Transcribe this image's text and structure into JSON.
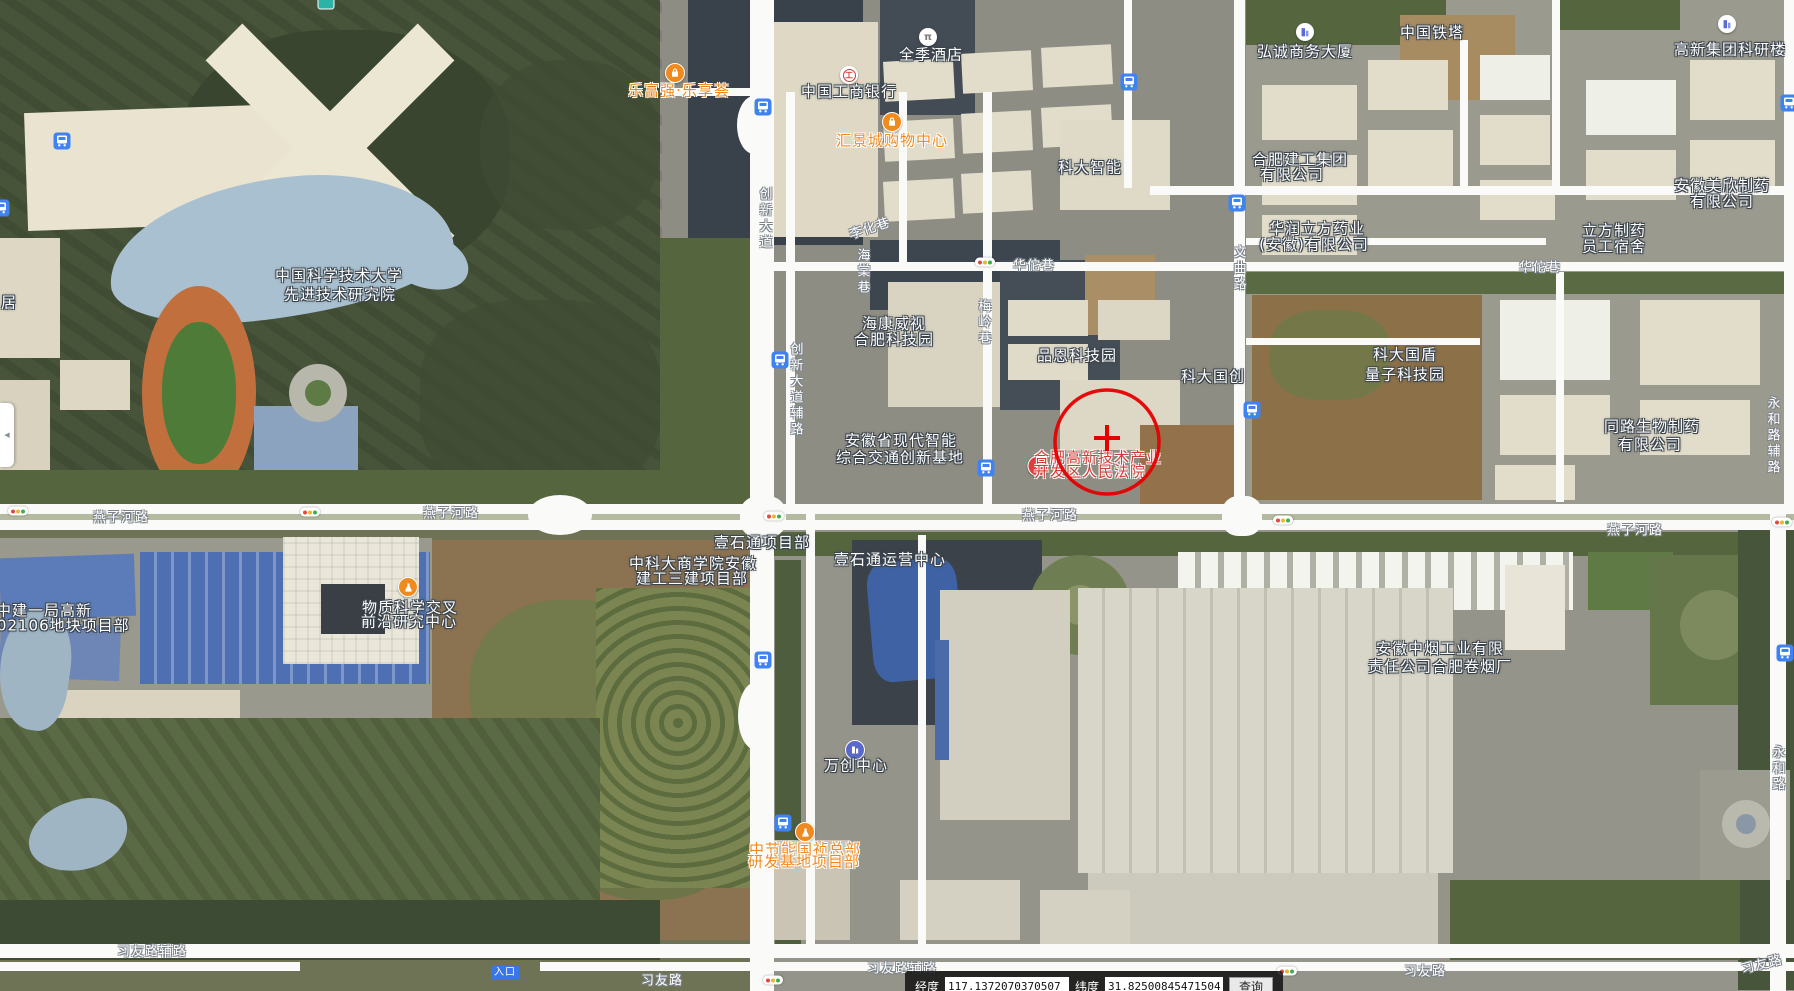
{
  "coord_bar": {
    "lng_label": "经度",
    "lng_value": "117.1372070370507",
    "lat_label": "纬度",
    "lat_value": "31.82500845471504",
    "search_label": "查询"
  },
  "entrance_tag": {
    "text": "入口",
    "x": 505,
    "y": 973
  },
  "side_panel": {
    "arrow": "◀"
  },
  "marker": {
    "circle": {
      "cx": 1107,
      "cy": 442,
      "r": 52,
      "color": "#e50000"
    },
    "cross": {
      "x": 1107,
      "y": 438,
      "arm": 13
    }
  },
  "labels": {
    "places": [
      {
        "t": "中国科学技术大学",
        "x": 339,
        "y": 276
      },
      {
        "t": "先进技术研究院",
        "x": 340,
        "y": 295
      },
      {
        "t": "中国工商银行",
        "x": 849,
        "y": 92
      },
      {
        "t": "全季酒店",
        "x": 931,
        "y": 55
      },
      {
        "t": "科大智能",
        "x": 1090,
        "y": 168
      },
      {
        "t": "弘诚商务大厦",
        "x": 1305,
        "y": 52
      },
      {
        "t": "中国铁塔",
        "x": 1432,
        "y": 33
      },
      {
        "t": "高新集团科研楼",
        "x": 1730,
        "y": 50
      },
      {
        "t": "合肥建工集团",
        "x": 1300,
        "y": 160
      },
      {
        "t": "有限公司",
        "x": 1292,
        "y": 175
      },
      {
        "t": "华润立方药业",
        "x": 1317,
        "y": 229
      },
      {
        "t": "(安徽)有限公司",
        "x": 1314,
        "y": 245
      },
      {
        "t": "立方制药",
        "x": 1614,
        "y": 231
      },
      {
        "t": "员工宿舍",
        "x": 1614,
        "y": 247
      },
      {
        "t": "安徽美欣制药",
        "x": 1722,
        "y": 186
      },
      {
        "t": "有限公司",
        "x": 1722,
        "y": 202
      },
      {
        "t": "海康威视",
        "x": 894,
        "y": 324
      },
      {
        "t": "合肥科技园",
        "x": 894,
        "y": 340
      },
      {
        "t": "品恩科技园",
        "x": 1077,
        "y": 356
      },
      {
        "t": "科大国创",
        "x": 1213,
        "y": 377
      },
      {
        "t": "科大国盾",
        "x": 1405,
        "y": 355
      },
      {
        "t": "量子科技园",
        "x": 1405,
        "y": 375
      },
      {
        "t": "同路生物制药",
        "x": 1652,
        "y": 427
      },
      {
        "t": "有限公司",
        "x": 1650,
        "y": 445
      },
      {
        "t": "安徽省现代智能",
        "x": 901,
        "y": 441
      },
      {
        "t": "综合交通创新基地",
        "x": 900,
        "y": 458
      },
      {
        "t": "中建一局高新",
        "x": 44,
        "y": 611
      },
      {
        "t": "202106地块项目部",
        "x": 58,
        "y": 626
      },
      {
        "t": "物质科学交叉",
        "x": 410,
        "y": 608
      },
      {
        "t": "前沿研究中心",
        "x": 409,
        "y": 622
      },
      {
        "t": "中科大商学院安徽",
        "x": 693,
        "y": 564
      },
      {
        "t": "建工三建项目部",
        "x": 692,
        "y": 579
      },
      {
        "t": "壹石通项目部",
        "x": 762,
        "y": 543
      },
      {
        "t": "壹石通运营中心",
        "x": 890,
        "y": 560
      },
      {
        "t": "万创中心",
        "x": 856,
        "y": 766
      },
      {
        "t": "安徽中烟工业有限",
        "x": 1440,
        "y": 649
      },
      {
        "t": "责任公司合肥卷烟厂",
        "x": 1440,
        "y": 667
      },
      {
        "t": "居",
        "x": 9,
        "y": 303
      }
    ],
    "orange": [
      {
        "t": "乐富强·乐享荟",
        "x": 679,
        "y": 91
      },
      {
        "t": "汇景城购物中心",
        "x": 892,
        "y": 141
      },
      {
        "t": "中节能国祯总部",
        "x": 805,
        "y": 850
      },
      {
        "t": "研发基地项目部",
        "x": 804,
        "y": 862
      }
    ],
    "red": [
      {
        "t": "合肥高新技术产业",
        "x": 1098,
        "y": 458
      },
      {
        "t": "开发区人民法院",
        "x": 1090,
        "y": 472
      }
    ],
    "roads": [
      {
        "t": "创新大道",
        "x": 764,
        "y": 219,
        "v": 1
      },
      {
        "t": "创新大道辅路",
        "x": 795,
        "y": 390,
        "v": 1
      },
      {
        "t": "华佗巷",
        "x": 1034,
        "y": 266
      },
      {
        "t": "华佗巷",
        "x": 1540,
        "y": 268
      },
      {
        "t": "梅岭巷",
        "x": 983,
        "y": 323,
        "v": 1
      },
      {
        "t": "文曲路",
        "x": 1238,
        "y": 269,
        "v": 1
      },
      {
        "t": "海棠巷",
        "x": 862,
        "y": 272,
        "v": 1
      },
      {
        "t": "李化巷",
        "x": 870,
        "y": 229,
        "r": -18
      },
      {
        "t": "永和路辅路",
        "x": 1772,
        "y": 436,
        "v": 1
      },
      {
        "t": "永和路",
        "x": 1777,
        "y": 769,
        "v": 1
      },
      {
        "t": "燕子河路",
        "x": 121,
        "y": 518
      },
      {
        "t": "燕子河路",
        "x": 451,
        "y": 514
      },
      {
        "t": "燕子河路",
        "x": 1050,
        "y": 516
      },
      {
        "t": "燕子河路",
        "x": 1635,
        "y": 531
      },
      {
        "t": "习友路辅路",
        "x": 152,
        "y": 952
      },
      {
        "t": "习友路",
        "x": 662,
        "y": 981
      },
      {
        "t": "习友路辅路",
        "x": 902,
        "y": 969
      },
      {
        "t": "习友路",
        "x": 1425,
        "y": 972
      },
      {
        "t": "习友路",
        "x": 1762,
        "y": 965,
        "r": -14
      }
    ]
  },
  "icons": {
    "bus_stops": [
      [
        62,
        141
      ],
      [
        1,
        208
      ],
      [
        763,
        107
      ],
      [
        1129,
        82
      ],
      [
        1237,
        203
      ],
      [
        780,
        360
      ],
      [
        1252,
        410
      ],
      [
        986,
        468
      ],
      [
        763,
        660
      ],
      [
        783,
        823
      ],
      [
        1785,
        653
      ],
      [
        1789,
        103
      ]
    ],
    "traffic_lights": [
      [
        985,
        262
      ],
      [
        18,
        511
      ],
      [
        310,
        512
      ],
      [
        774,
        516
      ],
      [
        1283,
        520
      ],
      [
        1782,
        522
      ],
      [
        773,
        980
      ],
      [
        1287,
        971
      ]
    ],
    "pois": [
      {
        "type": "shopping-bag",
        "x": 675,
        "y": 73
      },
      {
        "type": "shopping-bag",
        "x": 892,
        "y": 122
      },
      {
        "type": "bank",
        "x": 849,
        "y": 75
      },
      {
        "type": "hotel",
        "x": 928,
        "y": 37
      },
      {
        "type": "building",
        "x": 1305,
        "y": 32
      },
      {
        "type": "building",
        "x": 1727,
        "y": 24
      },
      {
        "type": "building-dark",
        "x": 855,
        "y": 750
      },
      {
        "type": "flask",
        "x": 408,
        "y": 587
      },
      {
        "type": "flask",
        "x": 805,
        "y": 832
      },
      {
        "type": "star",
        "x": 1038,
        "y": 466
      },
      {
        "type": "teal",
        "x": 326,
        "y": 2
      }
    ]
  }
}
